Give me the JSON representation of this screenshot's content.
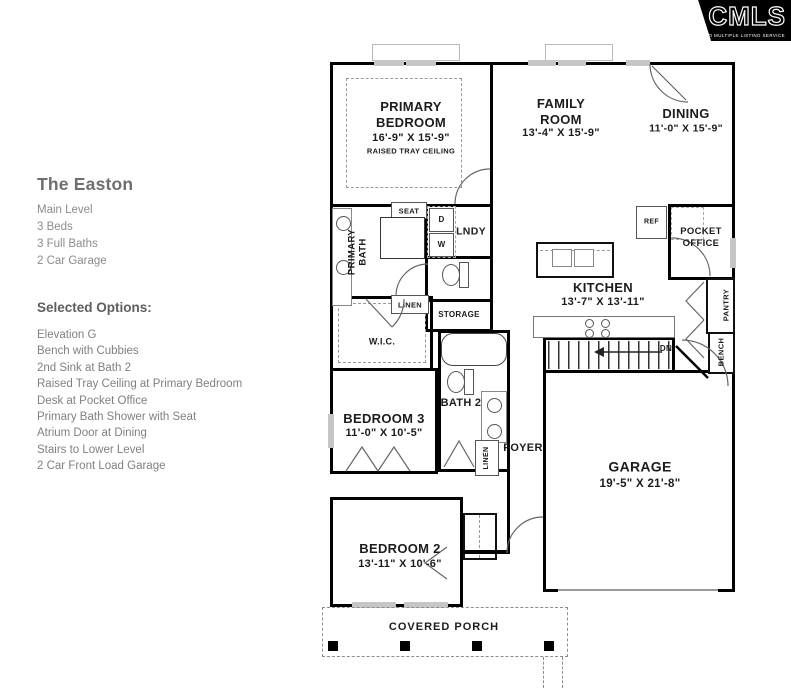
{
  "logo": {
    "name": "CMLS",
    "tagline": "CONSOLIDATED MULTIPLE LISTING SERVICE"
  },
  "info": {
    "title": "The Easton",
    "details": [
      "Main Level",
      "3 Beds",
      "3 Full Baths",
      "2 Car Garage"
    ],
    "options_heading": "Selected Options:",
    "options": [
      "Elevation G",
      "Bench with Cubbies",
      "2nd Sink at Bath 2",
      "Raised Tray Ceiling at Primary Bedroom",
      "Desk at Pocket Office",
      "Primary Bath Shower with Seat",
      "Atrium Door at Dining",
      "Stairs to Lower Level",
      "2 Car Front Load Garage"
    ]
  },
  "rooms": {
    "primary_bedroom": {
      "name": "PRIMARY BEDROOM",
      "dims": "16'-9\" X 15'-9\"",
      "note": "RAISED TRAY CEILING"
    },
    "family_room": {
      "name": "FAMILY ROOM",
      "dims": "13'-4\" X 15'-9\""
    },
    "dining": {
      "name": "DINING",
      "dims": "11'-0\" X 15'-9\""
    },
    "kitchen": {
      "name": "KITCHEN",
      "dims": "13'-7\" X 13'-11\""
    },
    "garage": {
      "name": "GARAGE",
      "dims": "19'-5\" X 21'-8\""
    },
    "bedroom_3": {
      "name": "BEDROOM 3",
      "dims": "11'-0\" X 10'-5\""
    },
    "bedroom_2": {
      "name": "BEDROOM 2",
      "dims": "13'-11\" X 10'-6\""
    },
    "bath_2": {
      "name": "BATH 2"
    },
    "primary_bath": {
      "name": "PRIMARY BATH"
    },
    "wic": {
      "name": "W.I.C."
    },
    "foyer": {
      "name": "FOYER"
    },
    "laundry": {
      "name": "LNDY"
    },
    "storage": {
      "name": "STORAGE"
    },
    "pocket_office": {
      "name": "POCKET OFFICE"
    },
    "pantry": {
      "name": "PANTRY"
    },
    "bench": {
      "name": "BENCH"
    },
    "covered_porch": {
      "name": "COVERED PORCH"
    }
  },
  "labels": {
    "seat": "SEAT",
    "linen": "LINEN",
    "ref": "REF",
    "dn": "DN",
    "washer": "W",
    "dryer": "D"
  },
  "colors": {
    "wall": "#000000",
    "plan_text": "#1c1c1c",
    "info_title": "#6e6f72",
    "info_text": "#85878a",
    "logo_bg": "#000000",
    "logo_text": "#ffffff",
    "window": "#c6c6c6"
  }
}
